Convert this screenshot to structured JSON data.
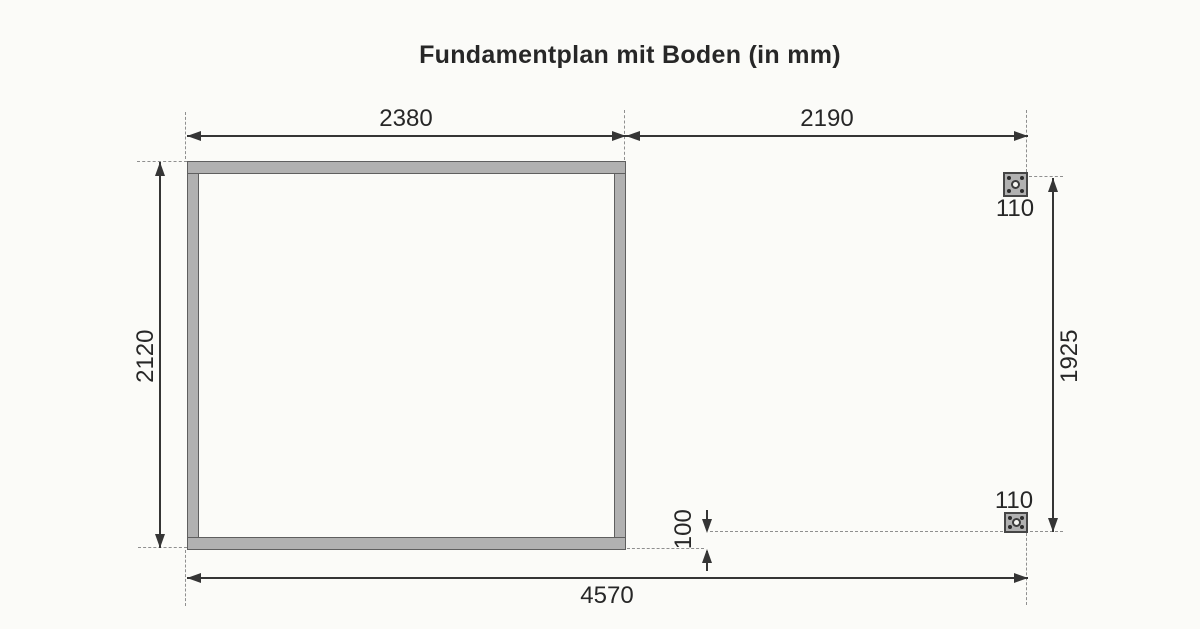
{
  "title": "Fundamentplan mit Boden (in mm)",
  "dimensions": {
    "floor_width": "2380",
    "right_extension": "2190",
    "floor_depth": "2120",
    "post_span": "1925",
    "post_plate_top": "110",
    "post_plate_bottom": "110",
    "post_offset": "100",
    "total_width": "4570"
  },
  "colors": {
    "background": "#fbfbf8",
    "frame_fill": "#b1b1b1",
    "frame_outline": "#5f5f5f",
    "dimension_line": "#353535",
    "extension_line": "#8f8f8f",
    "text": "#272727"
  }
}
